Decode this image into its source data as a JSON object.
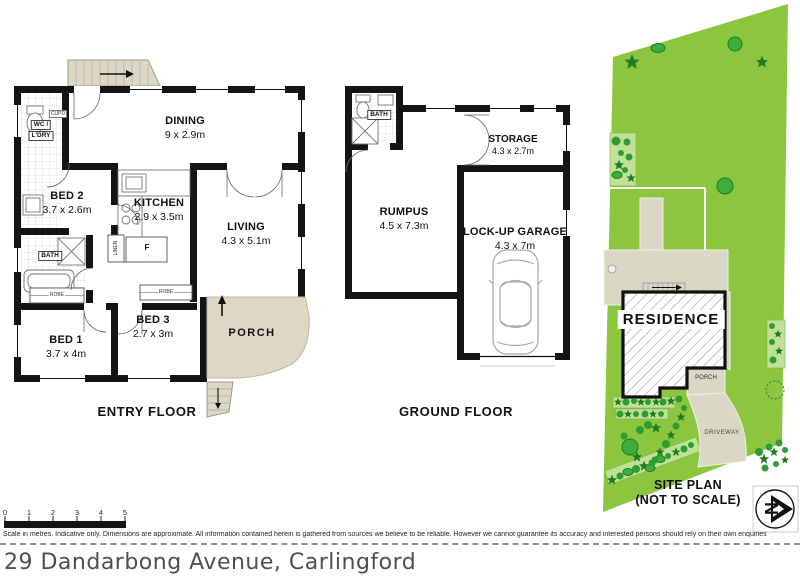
{
  "address": "29 Dandarbong Avenue, Carlingford",
  "disclaimer": "Scale in metres. Indicative only. Dimensions are approximate. All information contained herein is gathered from sources we believe to be reliable. However we cannot guarantee its accuracy and interested persons should rely on their own enquiries",
  "scale": {
    "ticks": [
      "0",
      "1",
      "2",
      "3",
      "4",
      "5"
    ]
  },
  "entry": {
    "title": "ENTRY FLOOR",
    "dining": {
      "name": "DINING",
      "dims": "9 x 2.9m"
    },
    "bed2": {
      "name": "BED 2",
      "dims": "3.7 x 2.6m"
    },
    "kitchen": {
      "name": "KITCHEN",
      "dims": "2.9 x 3.5m"
    },
    "living": {
      "name": "LIVING",
      "dims": "4.3 x 5.1m"
    },
    "bed1": {
      "name": "BED 1",
      "dims": "3.7 x 4m"
    },
    "bed3": {
      "name": "BED 3",
      "dims": "2.7 x 3m"
    },
    "porch": "PORCH",
    "bath": "BATH",
    "wc_line1": "WC /",
    "wc_line2": "L'DRY",
    "cupd": "CUPD",
    "linen": "LINEN",
    "robe1": "ROBE",
    "robe2": "ROBE",
    "fridge": "F"
  },
  "ground": {
    "title": "GROUND FLOOR",
    "rumpus": {
      "name": "RUMPUS",
      "dims": "4.5 x 7.3m"
    },
    "storage": {
      "name": "STORAGE",
      "dims": "4.3 x 2.7m"
    },
    "garage": {
      "name": "LOCK-UP GARAGE",
      "dims": "4.3 x 7m"
    },
    "bath": "BATH"
  },
  "site": {
    "title1": "SITE PLAN",
    "title2": "(NOT TO SCALE)",
    "residence": "RESIDENCE",
    "porch": "PORCH",
    "driveway": "DRIVEWAY",
    "compass_letter": "N",
    "colors": {
      "lawn": "#8cc63e",
      "shrub_dark": "#1f7d1f",
      "shrub_mid": "#3dae3d",
      "garden_bed": "#c0e095",
      "paving": "#dbd7c5",
      "wall": "#141414"
    }
  }
}
